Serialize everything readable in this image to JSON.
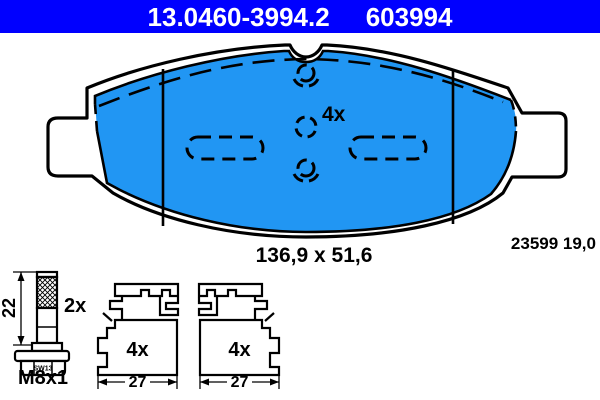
{
  "header": {
    "part_number": "13.0460-3994.2",
    "ref_number": "603994"
  },
  "colors": {
    "header_bg": "#0000ff",
    "header_text": "#ffffff",
    "friction_material": "#2196f3",
    "line": "#000000",
    "background": "#ffffff"
  },
  "pad": {
    "quantity_label": "4x",
    "dimensions_label": "136,9 x 51,6",
    "wva_label": "23599 19,0"
  },
  "bolt": {
    "length_label": "22",
    "quantity_label": "2x",
    "hex_label": "SW13",
    "thread_label": "M8x1"
  },
  "clip_left": {
    "quantity_label": "4x",
    "width_label": "27"
  },
  "clip_right": {
    "quantity_label": "4x",
    "width_label": "27"
  }
}
